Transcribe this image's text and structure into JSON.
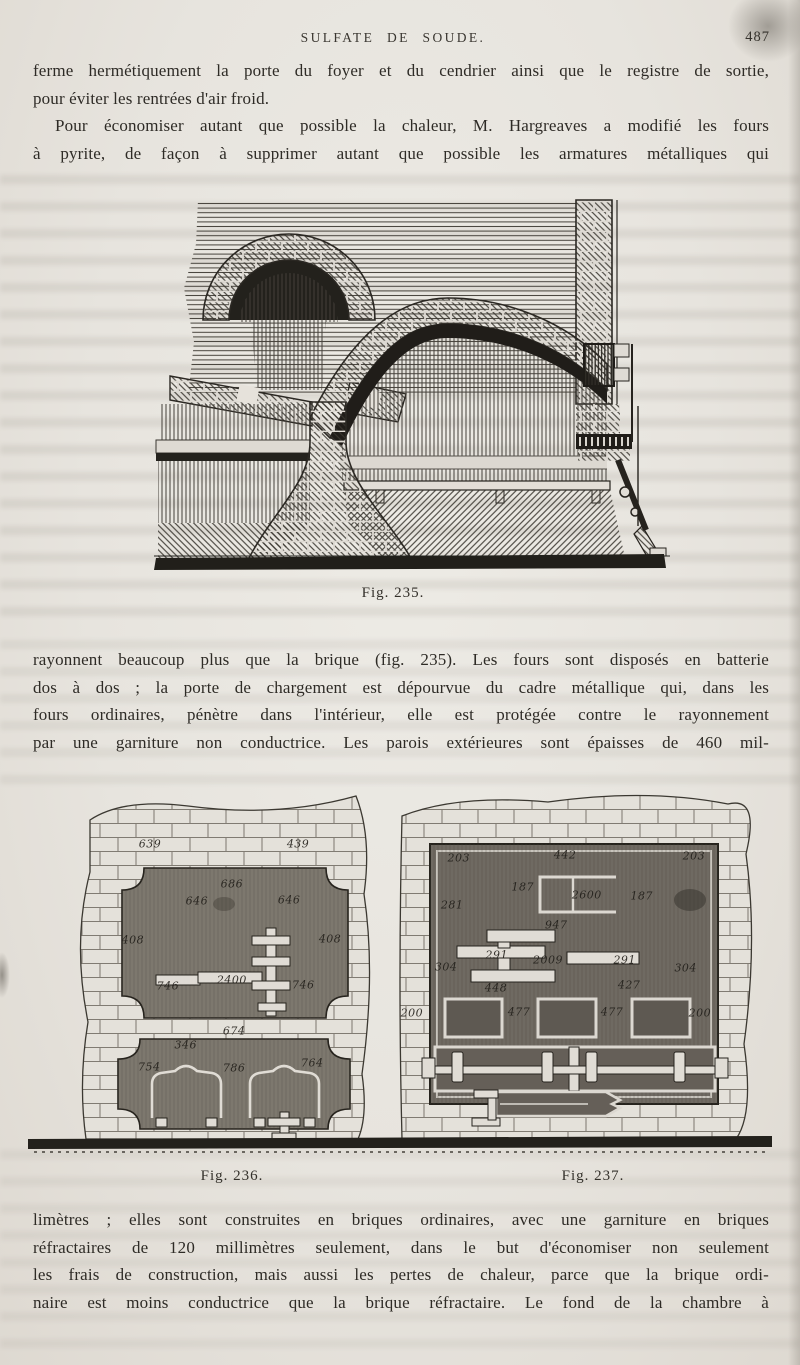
{
  "header": {
    "title": "SULFATE DE SOUDE.",
    "page_number": "487"
  },
  "paragraphs": {
    "p1": {
      "lines": [
        "ferme hermétiquement la porte du foyer et du cendrier ainsi que le registre de sortie,",
        "pour éviter les rentrées d'air froid."
      ]
    },
    "p2": {
      "lines": [
        "Pour économiser autant que possible la chaleur, M. Hargreaves a modifié les fours",
        "à pyrite, de façon à supprimer autant que possible les armatures métalliques qui"
      ]
    },
    "p3": {
      "lines": [
        "rayonnent beaucoup plus que la brique (fig. 235). Les fours sont disposés en batterie",
        "dos à dos ; la porte de chargement est dépourvue du cadre métallique qui, dans les",
        "fours ordinaires, pénètre dans l'intérieur, elle est protégée contre le rayonnement",
        "par une garniture non conductrice. Les parois extérieures sont épaisses de 460 mil-"
      ]
    },
    "p4": {
      "lines": [
        "limètres ; elles sont construites en briques ordinaires, avec une garniture en briques",
        "réfractaires de 120 millimètres seulement, dans le but d'économiser non seulement",
        "les frais de construction, mais aussi les pertes de chaleur, parce que la brique ordi-",
        "naire est moins conductrice que la brique réfractaire. Le fond de la chambre à"
      ]
    }
  },
  "figures": {
    "fig235": {
      "caption": "Fig. 235."
    },
    "fig236": {
      "caption": "Fig. 236.",
      "labels": [
        {
          "t": "639",
          "x": 16.4,
          "y": 16.7
        },
        {
          "t": "439",
          "x": 36.3,
          "y": 16.7
        },
        {
          "t": "686",
          "x": 27.4,
          "y": 27.2
        },
        {
          "t": "646",
          "x": 22.7,
          "y": 31.7
        },
        {
          "t": "646",
          "x": 35.1,
          "y": 31.5
        },
        {
          "t": "408",
          "x": 14.1,
          "y": 42.2
        },
        {
          "t": "408",
          "x": 40.6,
          "y": 41.9
        },
        {
          "t": "746",
          "x": 18.8,
          "y": 54.6
        },
        {
          "t": "2400",
          "x": 27.4,
          "y": 53.0
        },
        {
          "t": "746",
          "x": 37.0,
          "y": 54.3
        },
        {
          "t": "674",
          "x": 27.7,
          "y": 66.7
        },
        {
          "t": "346",
          "x": 21.2,
          "y": 70.2
        },
        {
          "t": "754",
          "x": 16.3,
          "y": 76.1
        },
        {
          "t": "786",
          "x": 27.7,
          "y": 76.6
        },
        {
          "t": "764",
          "x": 38.2,
          "y": 75.0
        }
      ]
    },
    "fig237": {
      "caption": "Fig. 237.",
      "labels": [
        {
          "t": "203",
          "x": 57.9,
          "y": 20.2
        },
        {
          "t": "442",
          "x": 72.2,
          "y": 19.4
        },
        {
          "t": "203",
          "x": 89.5,
          "y": 19.9
        },
        {
          "t": "187",
          "x": 66.5,
          "y": 28.2
        },
        {
          "t": "2600",
          "x": 75.1,
          "y": 30.1
        },
        {
          "t": "187",
          "x": 82.5,
          "y": 30.6
        },
        {
          "t": "281",
          "x": 57.0,
          "y": 32.8
        },
        {
          "t": "947",
          "x": 71.0,
          "y": 38.2
        },
        {
          "t": "291",
          "x": 63.0,
          "y": 46.2
        },
        {
          "t": "2009",
          "x": 69.9,
          "y": 47.6
        },
        {
          "t": "291",
          "x": 80.2,
          "y": 47.6
        },
        {
          "t": "304",
          "x": 56.2,
          "y": 49.5
        },
        {
          "t": "304",
          "x": 88.4,
          "y": 49.7
        },
        {
          "t": "448",
          "x": 62.9,
          "y": 55.1
        },
        {
          "t": "427",
          "x": 80.8,
          "y": 54.3
        },
        {
          "t": "200",
          "x": 51.6,
          "y": 61.8
        },
        {
          "t": "477",
          "x": 66.0,
          "y": 61.6
        },
        {
          "t": "477",
          "x": 78.5,
          "y": 61.6
        },
        {
          "t": "200",
          "x": 90.3,
          "y": 61.8
        }
      ]
    }
  },
  "colors": {
    "paper": "#e7e4de",
    "ink": "#2e2b26",
    "panel_gray": "#746f66",
    "mortar_line": "#666157"
  }
}
